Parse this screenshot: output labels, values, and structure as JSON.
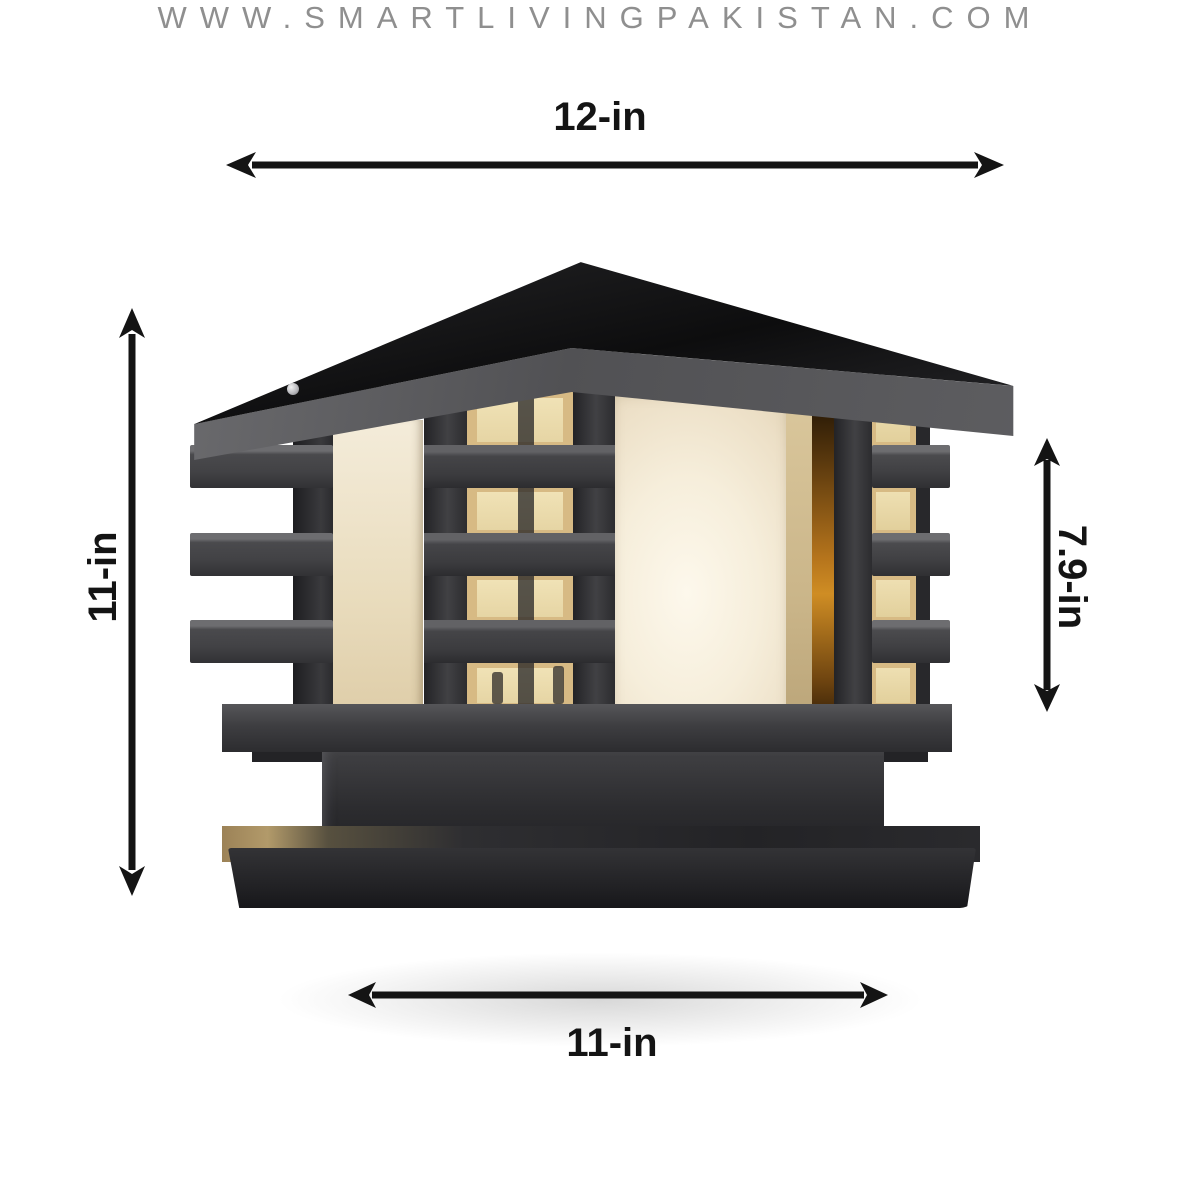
{
  "image": {
    "subject": "Black square pillar gate lamp with glowing frosted glass panels, shown with dimension arrows",
    "background": "#ffffff"
  },
  "dimensions": {
    "top": "12-in",
    "left": "11-in",
    "right": "7.9-in",
    "bottom": "11-in"
  },
  "watermark": "WWW.SMARTLIVINGPAKISTAN.COM",
  "colors": {
    "annotation": "#141414",
    "watermark_gray": "#8f8f8f",
    "lamp_frame": "#3a3a3d",
    "lamp_roof_black": "#121214",
    "glass_warm_white": "#f4ecd9",
    "glass_amber": "#d7ba84",
    "glow_orange": "#c07d1d"
  }
}
